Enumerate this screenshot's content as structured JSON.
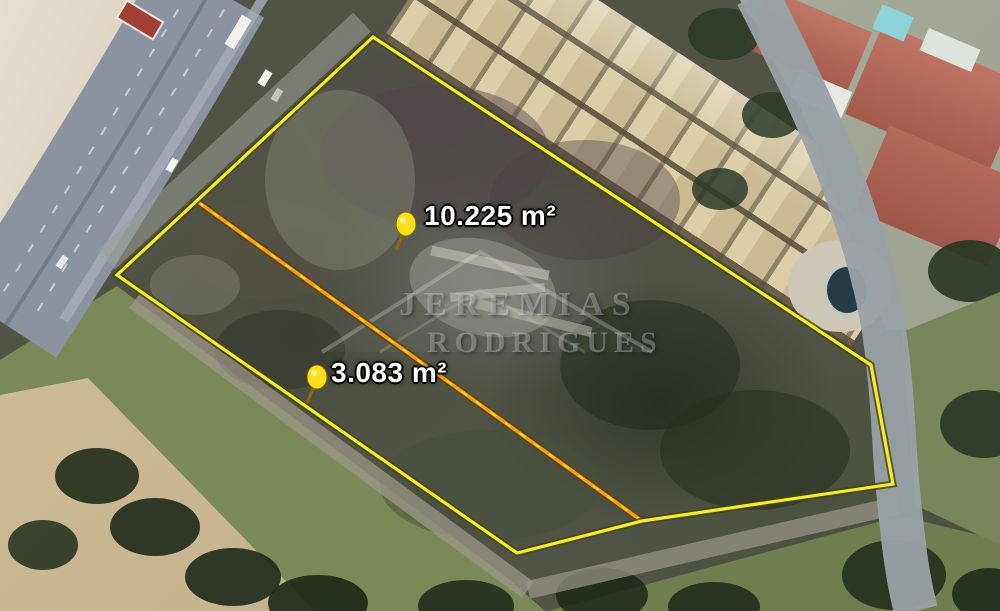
{
  "map": {
    "type": "satellite-aerial",
    "watermark": {
      "line1": "JEREMIAS",
      "line2": "RODRIGUES"
    },
    "measurements": [
      {
        "icon": "pushpin-icon",
        "label": "10.225 m²"
      },
      {
        "icon": "pushpin-icon",
        "label": "3.083 m²"
      }
    ],
    "colors": {
      "parcel_boundary": "#f2ee35",
      "lot_divider": "#eda31c",
      "pushpin": "#ffdf1c",
      "label_text": "#ffffff"
    }
  }
}
